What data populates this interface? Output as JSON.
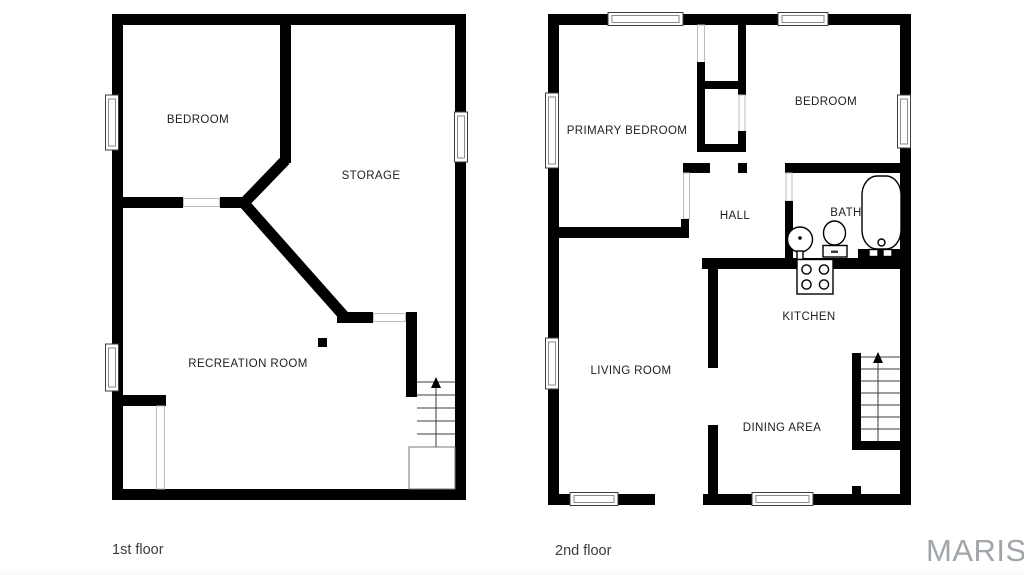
{
  "watermark": {
    "text": "MARIS",
    "color": "#a1a6ab"
  },
  "colors": {
    "background": "#ffffff",
    "wall": "#000000",
    "room_label": "#1c1e21",
    "caption": "#3a3d40"
  },
  "floors": [
    {
      "id": "first-floor",
      "caption": "1st floor",
      "rooms": [
        {
          "name": "bedroom",
          "label": "BEDROOM"
        },
        {
          "name": "storage",
          "label": "STORAGE"
        },
        {
          "name": "recreation-room",
          "label": "RECREATION ROOM"
        }
      ]
    },
    {
      "id": "second-floor",
      "caption": "2nd floor",
      "rooms": [
        {
          "name": "primary-bedroom",
          "label": "PRIMARY BEDROOM"
        },
        {
          "name": "bedroom",
          "label": "BEDROOM"
        },
        {
          "name": "hall",
          "label": "HALL"
        },
        {
          "name": "bath",
          "label": "BATH"
        },
        {
          "name": "kitchen",
          "label": "KITCHEN"
        },
        {
          "name": "living-room",
          "label": "LIVING ROOM"
        },
        {
          "name": "dining-area",
          "label": "DINING AREA"
        }
      ]
    }
  ]
}
